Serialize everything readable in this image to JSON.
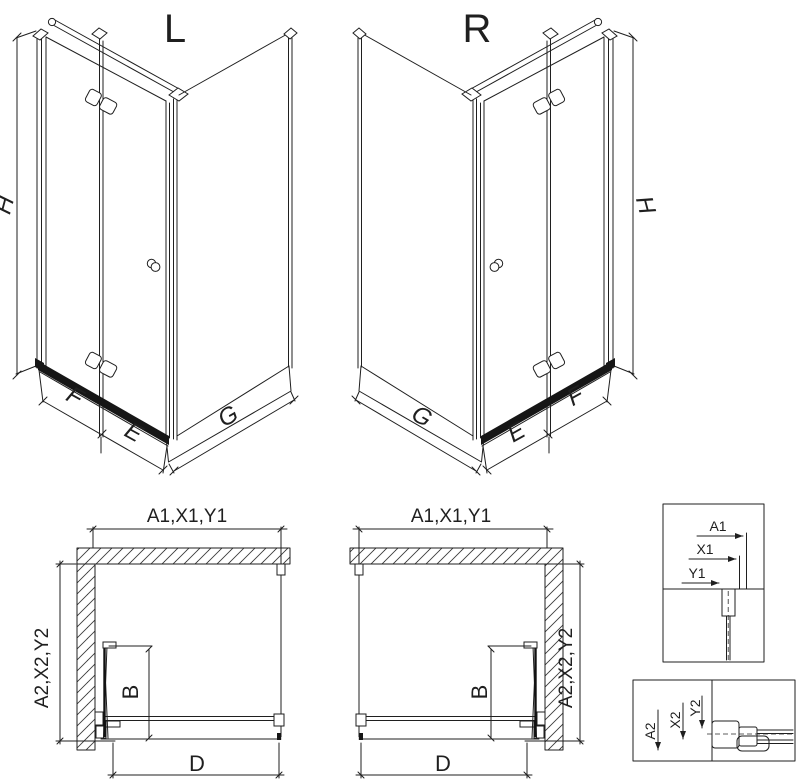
{
  "drawing": {
    "type_label_left": "L",
    "type_label_right": "R",
    "iso_dimensions": {
      "height": "H",
      "door_panel": "F",
      "entry": "E",
      "side_panel": "G"
    },
    "plan_dimensions": {
      "width": "A1,X1,Y1",
      "depth": "A2,X2,Y2",
      "door_depth": "B",
      "entry_width": "D"
    },
    "detail_wall_profile": {
      "a1": "A1",
      "x1": "X1",
      "y1": "Y1"
    },
    "detail_bottom_profile": {
      "a2": "A2",
      "x2": "X2",
      "y2": "Y2"
    },
    "colors": {
      "line": "#1f1f1f",
      "background": "#ffffff"
    }
  }
}
